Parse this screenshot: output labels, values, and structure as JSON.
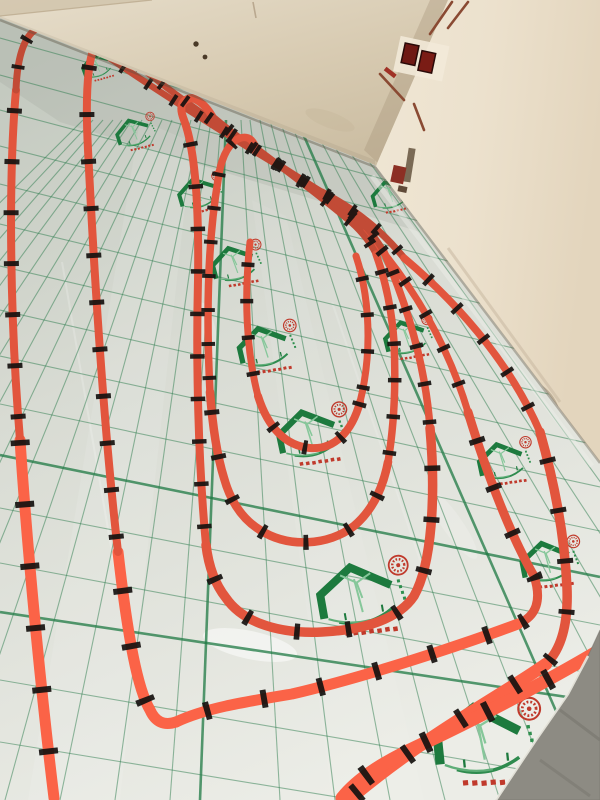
{
  "scene": {
    "label": "Unfinished room with red underfloor-heating pipe loops fixed by black clips onto silver insulation foil printed with a green grid and green house logos",
    "floor": {
      "covering": "foil-insulation",
      "grid_color": "#2f7d4f",
      "foil_color": "#dfe1da",
      "logo_label": "green-house-roof-logo-with-red-stamp",
      "logo_green": "#1d7a3e",
      "stamp_red": "#c03a2c",
      "bare_concrete_corner_color": "#8d8b83"
    },
    "pipes": {
      "material": "PEX heating pipe",
      "color_far": "#c24b36",
      "color_near": "#fb6347",
      "clip_color": "#161210",
      "layout": "nested serpentine loops with hairpin turns at the far wall",
      "visible_bottom_exits": 4
    },
    "walls": {
      "back_wall_color": "#d8cbb2",
      "right_wall_color": "#ece1cd",
      "features": [
        "two-drill-holes",
        "plaster-crack",
        "red-electrical-boxes",
        "conduit-chases"
      ],
      "electrical_box_color": "#6e1813"
    }
  }
}
